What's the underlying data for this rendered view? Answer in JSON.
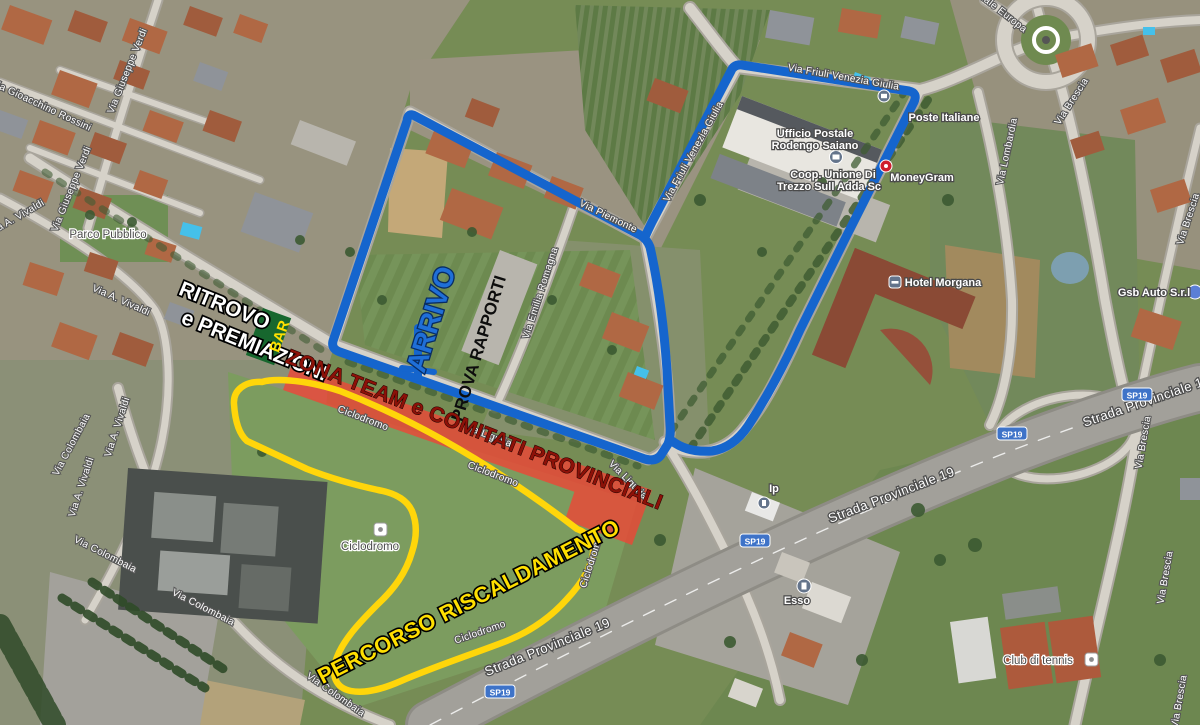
{
  "map": {
    "road_labels": [
      "Via Gioacchino Rossini",
      "Via Giuseppe Verdi",
      "Via Giuseppe Verdi",
      "Via A. Vivaldi",
      "Via A. Vivaldi",
      "Via A. Vivaldi",
      "Via A. Vivaldi",
      "Via Colombaia",
      "Via Colombaia",
      "Via Colombaia",
      "Via Colombaia",
      "Via Piemonte",
      "Via Emilia Romagna",
      "Via Friuli Venezia Giulia",
      "Via Friuli Venezia Giulia",
      "Via Liguria",
      "Via Liguria",
      "Via Lombardia",
      "Viale Europa",
      "Via Brescia",
      "Via Brescia",
      "Via Brescia",
      "Via Brescia",
      "Via Brescia",
      "Strada Provinciale 19",
      "Strada Provinciale 19",
      "Strada Provinciale 19",
      "Ciclodromo",
      "Ciclodromo",
      "Ciclodromo",
      "Ciclodromo"
    ],
    "poi": {
      "ufficio1": "Ufficio Postale",
      "ufficio2": "Rodengo Saiano",
      "poste": "Poste Italiane",
      "coop1": "Coop. Unione Di",
      "coop2": "Trezzo Sull Adda Sc",
      "moneygram": "MoneyGram",
      "hotel": "Hotel Morgana",
      "gsb": "Gsb Auto S.r.l",
      "ciclodromo": "Ciclodromo",
      "esso": "Esso",
      "ip": "Ip",
      "tennis": "Club di tennis",
      "parco": "Parco Pubblico"
    },
    "shield": "SP19"
  },
  "annotations": {
    "ritrovo1": "RITROVO",
    "ritrovo2": "e PREMIAZIONI",
    "bar": "BAR",
    "arrivo": "ARRIVO",
    "prova": "PROVA RAPPORTI",
    "zona": "ZONA TEAM e COMITATI PROVINCIALI",
    "percorso": "PERCORSO RISCALDAMENTO"
  },
  "colors": {
    "route_main": "#1565cd",
    "route_warmup": "#ffd60a",
    "team_zone_fill": "#ee4636",
    "zona_text": "#8c1108",
    "arrivo_text": "#1f6fd8",
    "bar_box": "#17672e",
    "bar_text": "#ffe000",
    "percorso_text": "#ffdf00",
    "shield_fill": "#3e73c8"
  }
}
